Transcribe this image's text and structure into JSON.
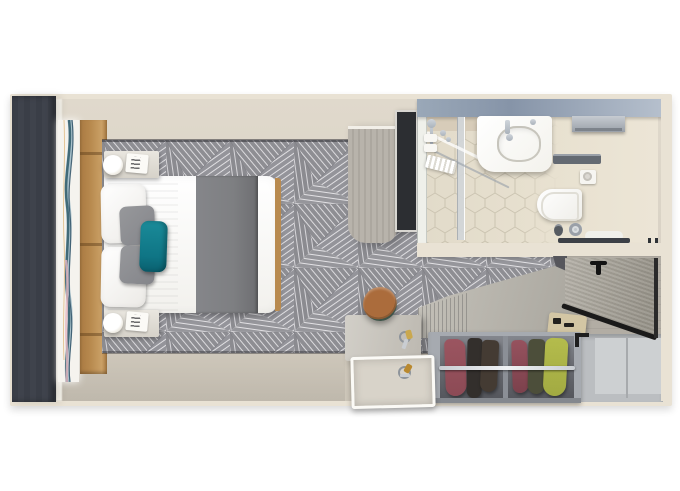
{
  "scene": {
    "label": "Cruise stateroom floor plan – top-down 3D render",
    "rooms": [
      {
        "name": "bedroom",
        "furniture": [
          "balcony-window-slab",
          "wall-art-panel",
          "tufted-headboard",
          "double-bed",
          "gray-bed-runner",
          "white-pillows",
          "gray-pillows",
          "teal-accent-pillow",
          "nightstand-top",
          "nightstand-bottom",
          "table-lamp-top",
          "table-lamp-bottom",
          "patterned-carpet"
        ]
      },
      {
        "name": "bathroom",
        "furniture": [
          "shower-enclosure",
          "shower-glass-divider",
          "shower-fixtures",
          "fold-down-shower-seat",
          "vanity-sink",
          "faucet",
          "towel-rail",
          "towel-shelf",
          "toilet",
          "toilet-paper-holder",
          "waste-bin",
          "toilet-brush",
          "bath-mat",
          "towel-bar-bottom",
          "hexagon-tile-floor"
        ]
      },
      {
        "name": "dressing-area",
        "furniture": [
          "divider-cabinet",
          "wall-tv",
          "writing-desk",
          "open-drawer-tray",
          "keys",
          "round-stool",
          "slatted-counter",
          "open-wardrobe",
          "hanging-clothes",
          "clothes-rail",
          "luggage-bench",
          "entry-door",
          "door-handle",
          "empty-side-cabinet"
        ]
      }
    ]
  },
  "palette": {
    "wall": "#e9e2d4",
    "floorLight": "#e0d9cc",
    "floorDark": "#cdc6b9",
    "carpetBase": "#909095",
    "carpetLine": "#dcdbde",
    "slab": "#3f434c",
    "headboard": "#b88a4f",
    "bedWhite": "#f2f1ed",
    "runner": "#7e7f82",
    "tealPillow": "#0f7585",
    "grayPillow": "#84858a",
    "lampWhite": "#efece4",
    "bathTopA": "#8694a8",
    "bathTopB": "#b6c0cd",
    "bathFloor": "#e8e1d0",
    "tileLine": "#cbc4b1",
    "chrome": "#aab2bb",
    "fixtureWhite": "#f3f2ec",
    "divider": "#aca79f",
    "tvScreen": "#2c2e32",
    "tvFrame": "#d8d6d1",
    "doorWood": "#979389",
    "doorTrim": "#1a1a1a",
    "corridor": "#b2ada4",
    "counter": "#a9a69e",
    "wardrobeDark": "#55575d",
    "maroonCloth": "#8c4a55",
    "darkCloth": "#383330",
    "oliveCloth": "#4c4e3a",
    "chartreuseCloth": "#a2aa42",
    "cabinetRight": "#bbbec1",
    "deskTop": "#bdb9b1",
    "trayFace": "#fbfaf6",
    "trayIn": "#d8d3c9",
    "stoolRim": "#3f5449",
    "stoolSeat": "#ab6c3c",
    "benchTan": "#d3c6a4",
    "artTeal": "#35606f",
    "artBlue": "#7fa6b8",
    "artPink": "#e7b9c3",
    "artAmber": "#d9a95f"
  }
}
